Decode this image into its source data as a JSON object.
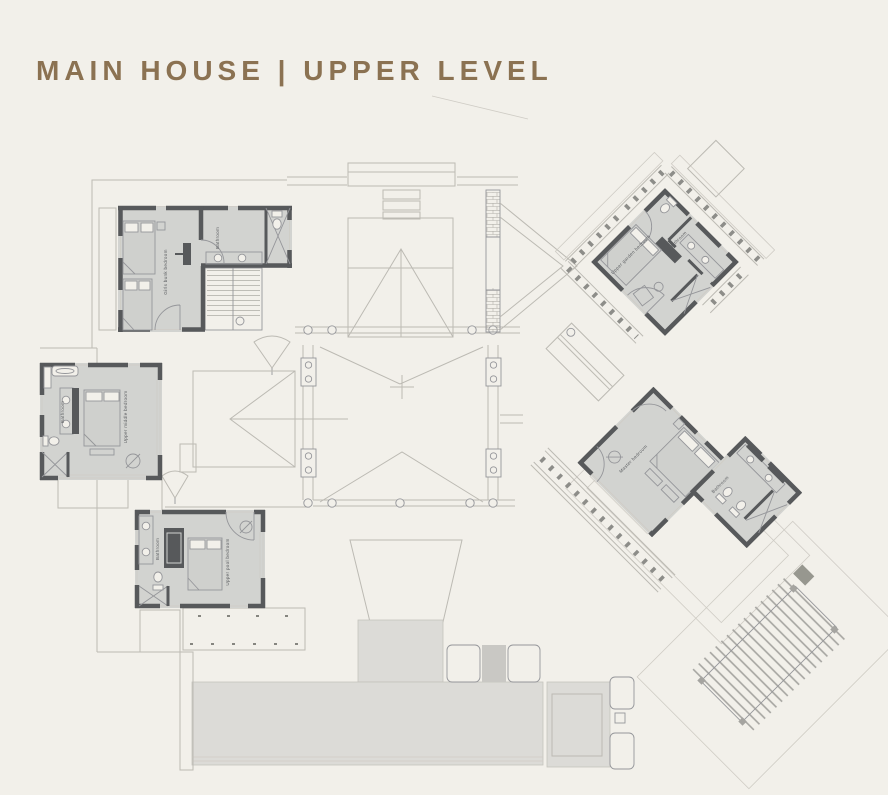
{
  "title": "MAIN HOUSE | UPPER LEVEL",
  "plan": {
    "rooms": {
      "girls_bunk_bedroom": "Girls bunk bedroom",
      "upper_middle_bedroom": "Upper middle bedroom",
      "upper_pool_bedroom": "Upper pool bedroom",
      "upper_garden_bedroom": "Upper garden bedroom",
      "master_bedroom": "Master bedroom",
      "bathroom": "Bathroom"
    },
    "colors": {
      "background": "#f2f0ea",
      "title": "#8b7252",
      "walls": "#57595b",
      "floor": "#d2d3d0",
      "terrace": "#dcdbd7",
      "lines": "#bcbab3"
    }
  }
}
